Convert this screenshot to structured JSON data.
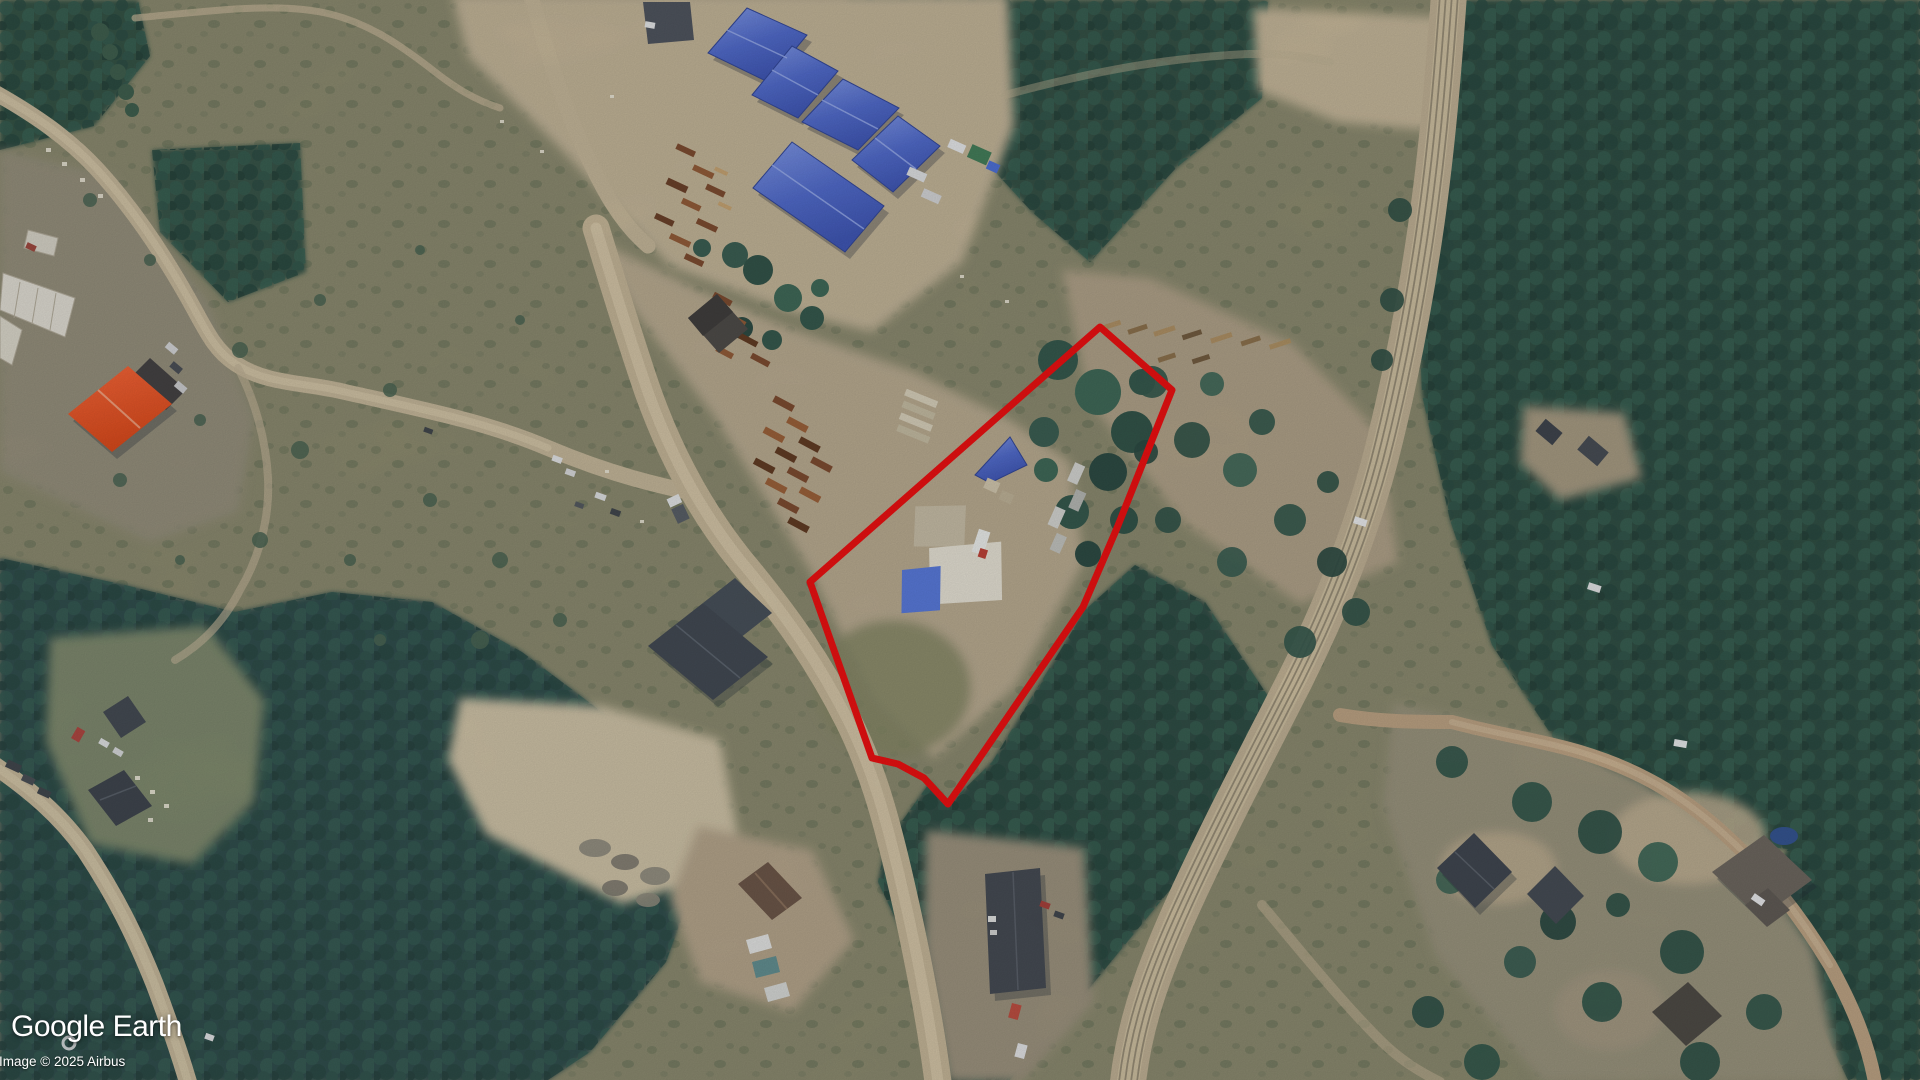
{
  "app": {
    "name": "Google Earth"
  },
  "attribution": {
    "logo_text": "Google Earth",
    "copyright_text": "Image © 2025 Airbus"
  },
  "parcel_overlay": {
    "points": "810,582 1100,327 1172,390 1117,528 1083,607 948,804 924,778 898,764 872,758",
    "color": "#f30505",
    "width": "7"
  },
  "palette": {
    "boundary_red": "#f30505",
    "warehouse_roof_blue": "#5572d6",
    "building_orange": "#f4511e",
    "forest_green": "#2b4a3b",
    "dirt_road_tan": "#c9b897"
  },
  "scene": {
    "description": "Aerial satellite imagery of a rural industrial lumber-yard area with blue storage warehouses, dirt roads, a rail corridor, forest and houses; red outline marks a property parcel"
  }
}
